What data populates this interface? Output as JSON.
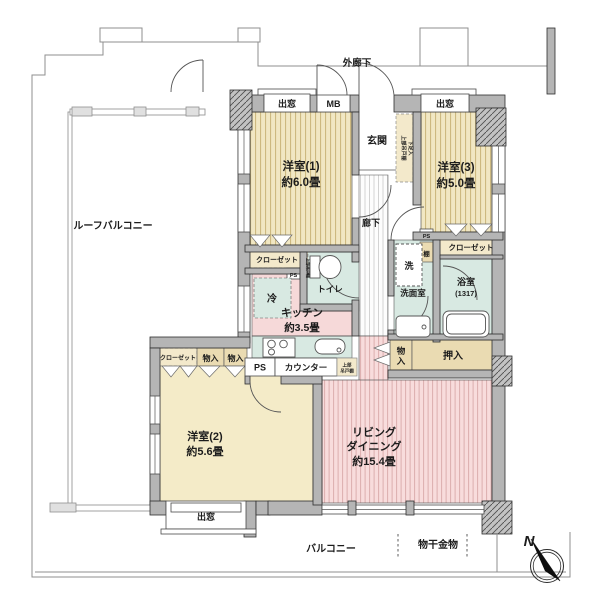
{
  "floorplan": {
    "compass": "N",
    "exterior": {
      "outer_corridor": "外廊下",
      "roof_balcony": "ルーフバルコニー",
      "balcony": "バルコニー",
      "laundry_fitting": "物干金物"
    },
    "openings": {
      "bay_window": "出窓",
      "meter_box": "MB"
    },
    "rooms": {
      "western1_name": "洋室(1)",
      "western1_area": "約6.0畳",
      "western2_name": "洋室(2)",
      "western2_area": "約5.6畳",
      "western3_name": "洋室(3)",
      "western3_area": "約5.0畳",
      "living_line1": "リビング",
      "living_line2": "ダイニング",
      "living_area": "約15.4畳",
      "kitchen_name": "キッチン",
      "kitchen_area": "約3.5畳",
      "entrance": "玄関",
      "hallway": "廊下",
      "toilet": "トイレ",
      "washroom": "洗面室",
      "bathroom_name": "浴室",
      "bathroom_size": "(1317)"
    },
    "storage": {
      "closet": "クローゼット",
      "oshiire": "押入",
      "monoire": "物入",
      "monoire_char1": "物",
      "monoire_char2": "入",
      "shelf": "棚",
      "shoe_box": "下足入",
      "upper_cabinet": "上部吊戸棚",
      "upper_cabinet_l1": "上部",
      "upper_cabinet_l2": "吊戸棚"
    },
    "fixtures": {
      "fridge": "冷",
      "washer": "洗",
      "counter": "カウンター",
      "pipe_space": "PS"
    }
  }
}
